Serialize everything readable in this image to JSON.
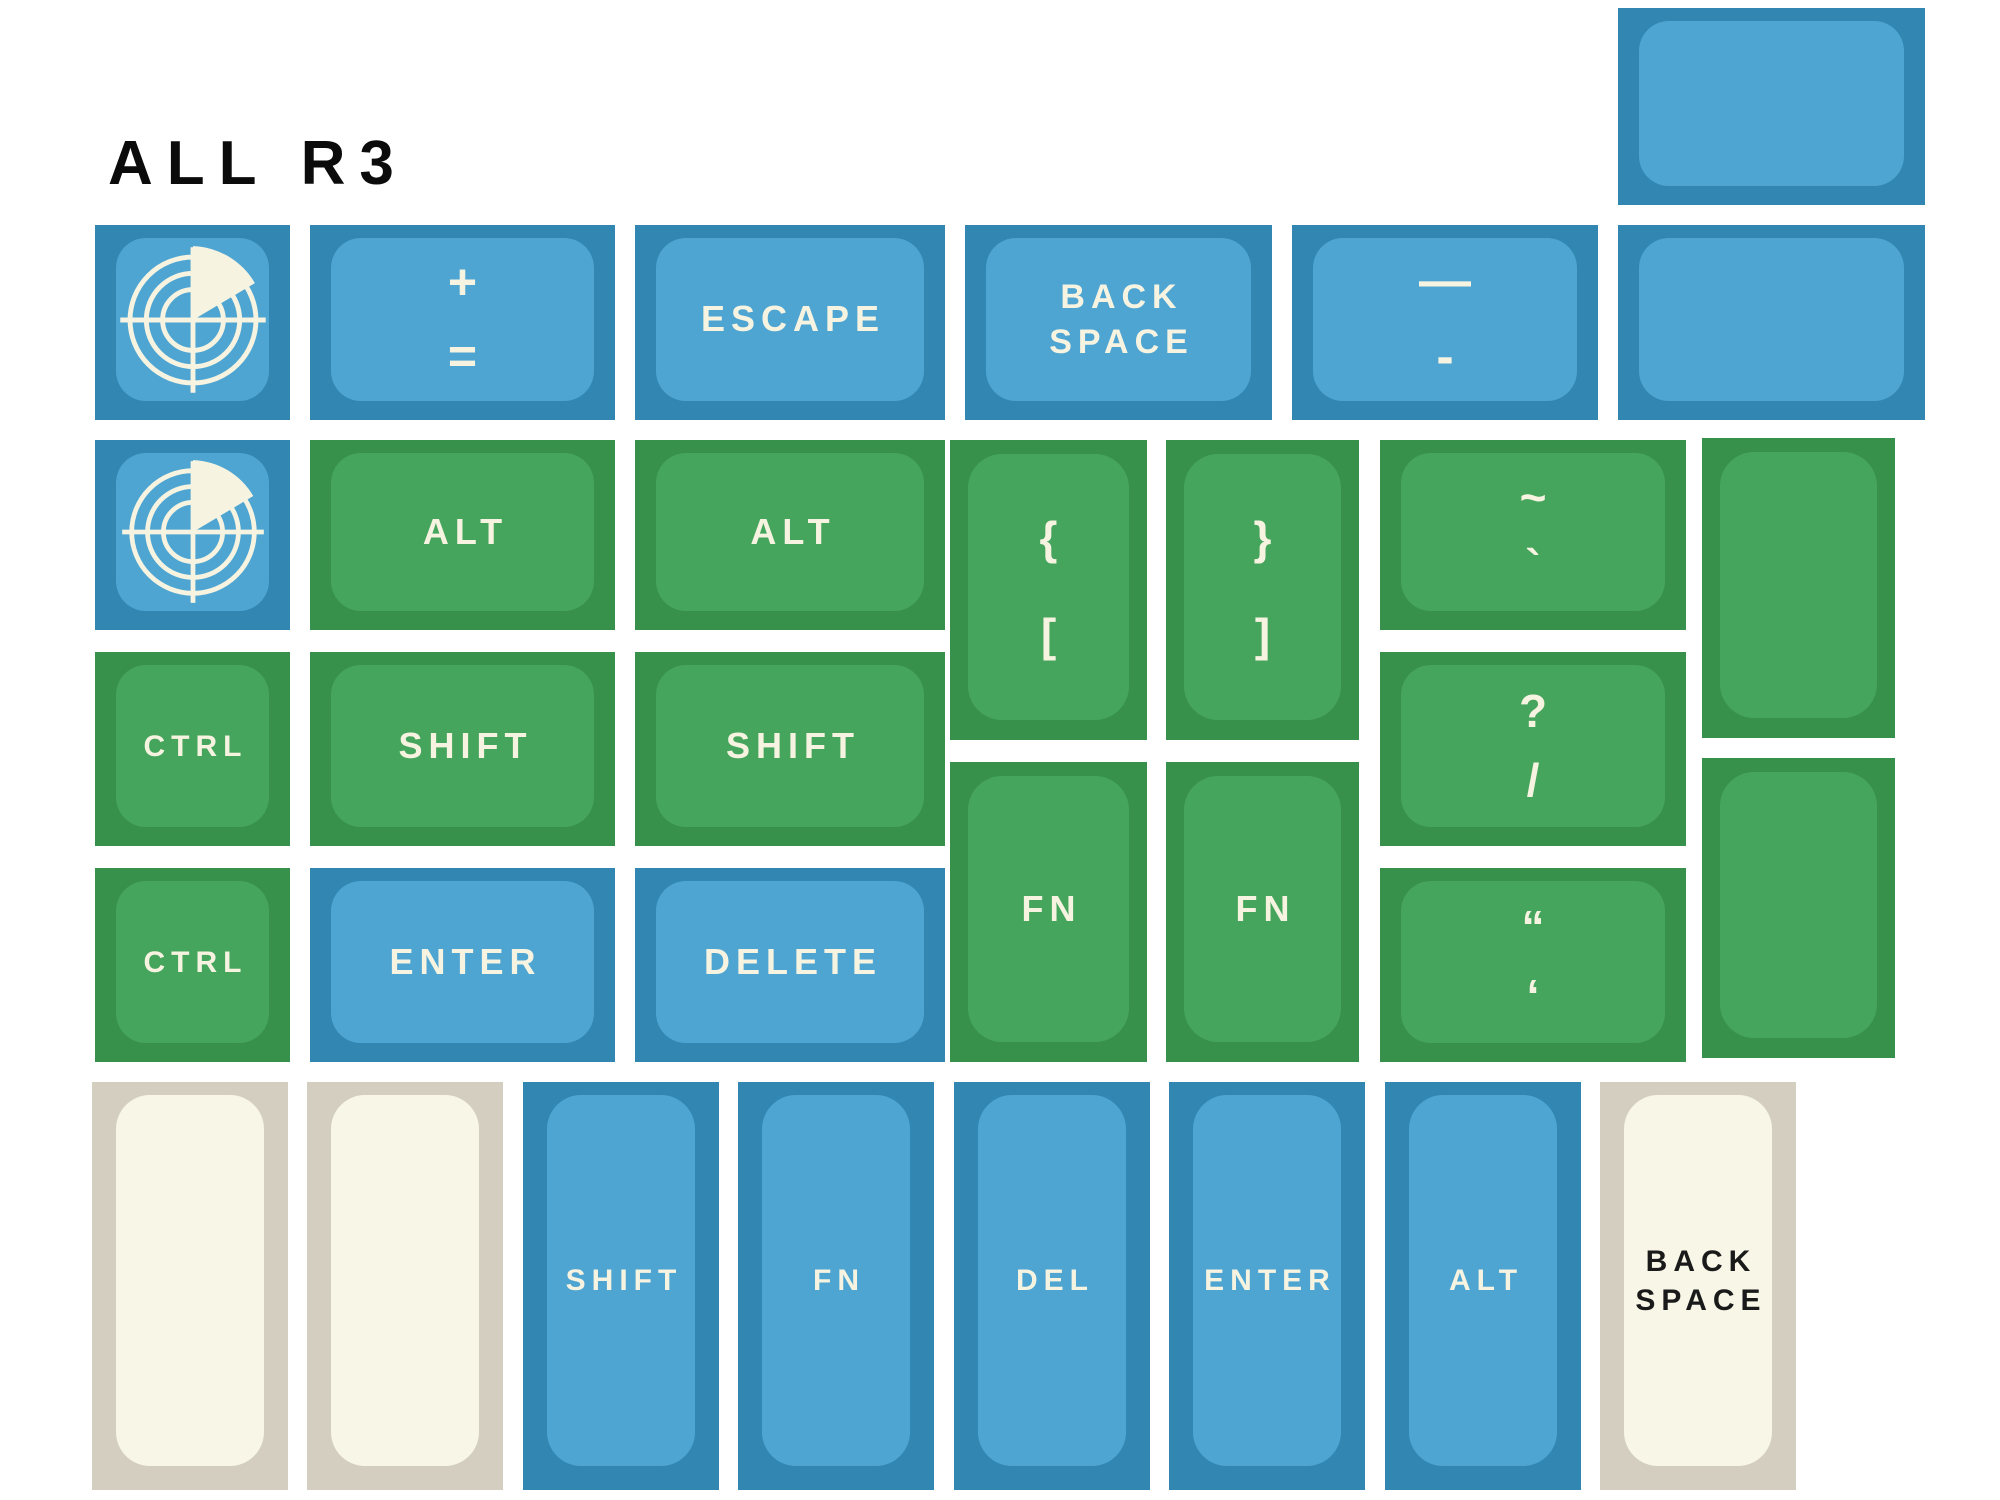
{
  "title": "ALL R3",
  "palette": {
    "background": "#ffffff",
    "title_ink": "#0b0b0b",
    "blue_outer": "#3187b2",
    "blue_inner": "#4ea5d2",
    "green_outer": "#38914b",
    "green_inner": "#46a55d",
    "cream_outer": "#d3cec0",
    "cream_inner": "#f8f6e6",
    "legend_light": "#f6f3e1",
    "legend_dark": "#1a1a1a"
  },
  "icons": {
    "radar": "radar-icon"
  },
  "keys": [
    {
      "name": "blank-key-top-right",
      "color": "blue",
      "x": 1618,
      "y": 8,
      "w": 307,
      "h": 197
    },
    {
      "name": "radar-key-row1",
      "color": "blue",
      "x": 95,
      "y": 225,
      "w": 195,
      "h": 195,
      "icon": "radar-icon"
    },
    {
      "name": "plus-equals-key",
      "color": "blue",
      "x": 310,
      "y": 225,
      "w": 305,
      "h": 195,
      "legend": {
        "lines": [
          "+",
          "="
        ],
        "style": "symbol",
        "size": 50
      }
    },
    {
      "name": "escape-key",
      "color": "blue",
      "x": 635,
      "y": 225,
      "w": 310,
      "h": 195,
      "legend": {
        "lines": [
          "ESCAPE"
        ],
        "style": "word",
        "size": 36
      }
    },
    {
      "name": "backspace-key-row1",
      "color": "blue",
      "x": 965,
      "y": 225,
      "w": 307,
      "h": 195,
      "legend": {
        "lines": [
          "BACK",
          "SPACE"
        ],
        "style": "word",
        "size": 34
      }
    },
    {
      "name": "underscore-hyphen-key",
      "color": "blue",
      "x": 1292,
      "y": 225,
      "w": 306,
      "h": 195,
      "legend": {
        "lines": [
          "—",
          "-"
        ],
        "style": "symbol",
        "size": 52
      }
    },
    {
      "name": "blank-key-row1",
      "color": "blue",
      "x": 1618,
      "y": 225,
      "w": 307,
      "h": 195
    },
    {
      "name": "radar-key-row2",
      "color": "blue",
      "x": 95,
      "y": 440,
      "w": 195,
      "h": 190,
      "icon": "radar-icon"
    },
    {
      "name": "alt-key-left",
      "color": "green",
      "x": 310,
      "y": 440,
      "w": 305,
      "h": 190,
      "legend": {
        "lines": [
          "ALT"
        ],
        "style": "word",
        "size": 36
      }
    },
    {
      "name": "alt-key-right",
      "color": "green",
      "x": 635,
      "y": 440,
      "w": 310,
      "h": 190,
      "legend": {
        "lines": [
          "ALT"
        ],
        "style": "word",
        "size": 36
      }
    },
    {
      "name": "brace-bracket-left-key",
      "color": "green",
      "x": 950,
      "y": 440,
      "w": 197,
      "h": 300,
      "tall": true,
      "legend": {
        "lines": [
          "{",
          "["
        ],
        "style": "symbol",
        "size": 46
      }
    },
    {
      "name": "brace-bracket-right-key",
      "color": "green",
      "x": 1166,
      "y": 440,
      "w": 193,
      "h": 300,
      "tall": true,
      "legend": {
        "lines": [
          "}",
          "]"
        ],
        "style": "symbol",
        "size": 46
      }
    },
    {
      "name": "tilde-grave-key",
      "color": "green",
      "x": 1380,
      "y": 440,
      "w": 306,
      "h": 190,
      "legend": {
        "lines": [
          "~",
          "`"
        ],
        "style": "symbol",
        "size": 46
      }
    },
    {
      "name": "blank-key-green-upper",
      "color": "green",
      "x": 1702,
      "y": 438,
      "w": 193,
      "h": 300,
      "tall": true
    },
    {
      "name": "ctrl-key-row3",
      "color": "green",
      "x": 95,
      "y": 652,
      "w": 195,
      "h": 194,
      "legend": {
        "lines": [
          "CTRL"
        ],
        "style": "word",
        "size": 30
      }
    },
    {
      "name": "shift-key-left",
      "color": "green",
      "x": 310,
      "y": 652,
      "w": 305,
      "h": 194,
      "legend": {
        "lines": [
          "SHIFT"
        ],
        "style": "word",
        "size": 36
      }
    },
    {
      "name": "shift-key-right",
      "color": "green",
      "x": 635,
      "y": 652,
      "w": 310,
      "h": 194,
      "legend": {
        "lines": [
          "SHIFT"
        ],
        "style": "word",
        "size": 36
      }
    },
    {
      "name": "question-slash-key",
      "color": "green",
      "x": 1380,
      "y": 652,
      "w": 306,
      "h": 194,
      "legend": {
        "lines": [
          "?",
          "/"
        ],
        "style": "symbol",
        "size": 46
      }
    },
    {
      "name": "ctrl-key-row4",
      "color": "green",
      "x": 95,
      "y": 868,
      "w": 195,
      "h": 194,
      "legend": {
        "lines": [
          "CTRL"
        ],
        "style": "word",
        "size": 30
      }
    },
    {
      "name": "enter-key-row4",
      "color": "blue",
      "x": 310,
      "y": 868,
      "w": 305,
      "h": 194,
      "legend": {
        "lines": [
          "ENTER"
        ],
        "style": "word",
        "size": 36
      }
    },
    {
      "name": "delete-key",
      "color": "blue",
      "x": 635,
      "y": 868,
      "w": 310,
      "h": 194,
      "legend": {
        "lines": [
          "DELETE"
        ],
        "style": "word",
        "size": 36
      }
    },
    {
      "name": "fn-key-left",
      "color": "green",
      "x": 950,
      "y": 762,
      "w": 197,
      "h": 300,
      "tall": true,
      "legend": {
        "lines": [
          "FN"
        ],
        "style": "word",
        "size": 36
      }
    },
    {
      "name": "fn-key-right",
      "color": "green",
      "x": 1166,
      "y": 762,
      "w": 193,
      "h": 300,
      "tall": true,
      "legend": {
        "lines": [
          "FN"
        ],
        "style": "word",
        "size": 36
      }
    },
    {
      "name": "double-single-quote-key",
      "color": "green",
      "x": 1380,
      "y": 868,
      "w": 306,
      "h": 194,
      "legend": {
        "lines": [
          "“",
          "‘"
        ],
        "style": "symbol",
        "size": 46
      }
    },
    {
      "name": "blank-key-green-lower",
      "color": "green",
      "x": 1702,
      "y": 758,
      "w": 193,
      "h": 300,
      "tall": true
    },
    {
      "name": "blank-key-cream-1",
      "color": "cream",
      "x": 92,
      "y": 1082,
      "w": 196,
      "h": 408,
      "vert": true
    },
    {
      "name": "blank-key-cream-2",
      "color": "cream",
      "x": 307,
      "y": 1082,
      "w": 196,
      "h": 408,
      "vert": true
    },
    {
      "name": "shift-key-bottom",
      "color": "blue",
      "x": 523,
      "y": 1082,
      "w": 196,
      "h": 408,
      "vert": true,
      "legend": {
        "lines": [
          "SHIFT"
        ],
        "style": "word",
        "size": 30
      }
    },
    {
      "name": "fn-key-bottom",
      "color": "blue",
      "x": 738,
      "y": 1082,
      "w": 196,
      "h": 408,
      "vert": true,
      "legend": {
        "lines": [
          "FN"
        ],
        "style": "word",
        "size": 30
      }
    },
    {
      "name": "del-key-bottom",
      "color": "blue",
      "x": 954,
      "y": 1082,
      "w": 196,
      "h": 408,
      "vert": true,
      "legend": {
        "lines": [
          "DEL"
        ],
        "style": "word",
        "size": 30
      }
    },
    {
      "name": "enter-key-bottom",
      "color": "blue",
      "x": 1169,
      "y": 1082,
      "w": 196,
      "h": 408,
      "vert": true,
      "legend": {
        "lines": [
          "ENTER"
        ],
        "style": "word",
        "size": 30
      }
    },
    {
      "name": "alt-key-bottom",
      "color": "blue",
      "x": 1385,
      "y": 1082,
      "w": 196,
      "h": 408,
      "vert": true,
      "legend": {
        "lines": [
          "ALT"
        ],
        "style": "word",
        "size": 30
      }
    },
    {
      "name": "backspace-key-bottom",
      "color": "cream",
      "x": 1600,
      "y": 1082,
      "w": 196,
      "h": 408,
      "vert": true,
      "legend": {
        "lines": [
          "BACK",
          "SPACE"
        ],
        "style": "word",
        "size": 30,
        "tone": "dark"
      }
    }
  ]
}
